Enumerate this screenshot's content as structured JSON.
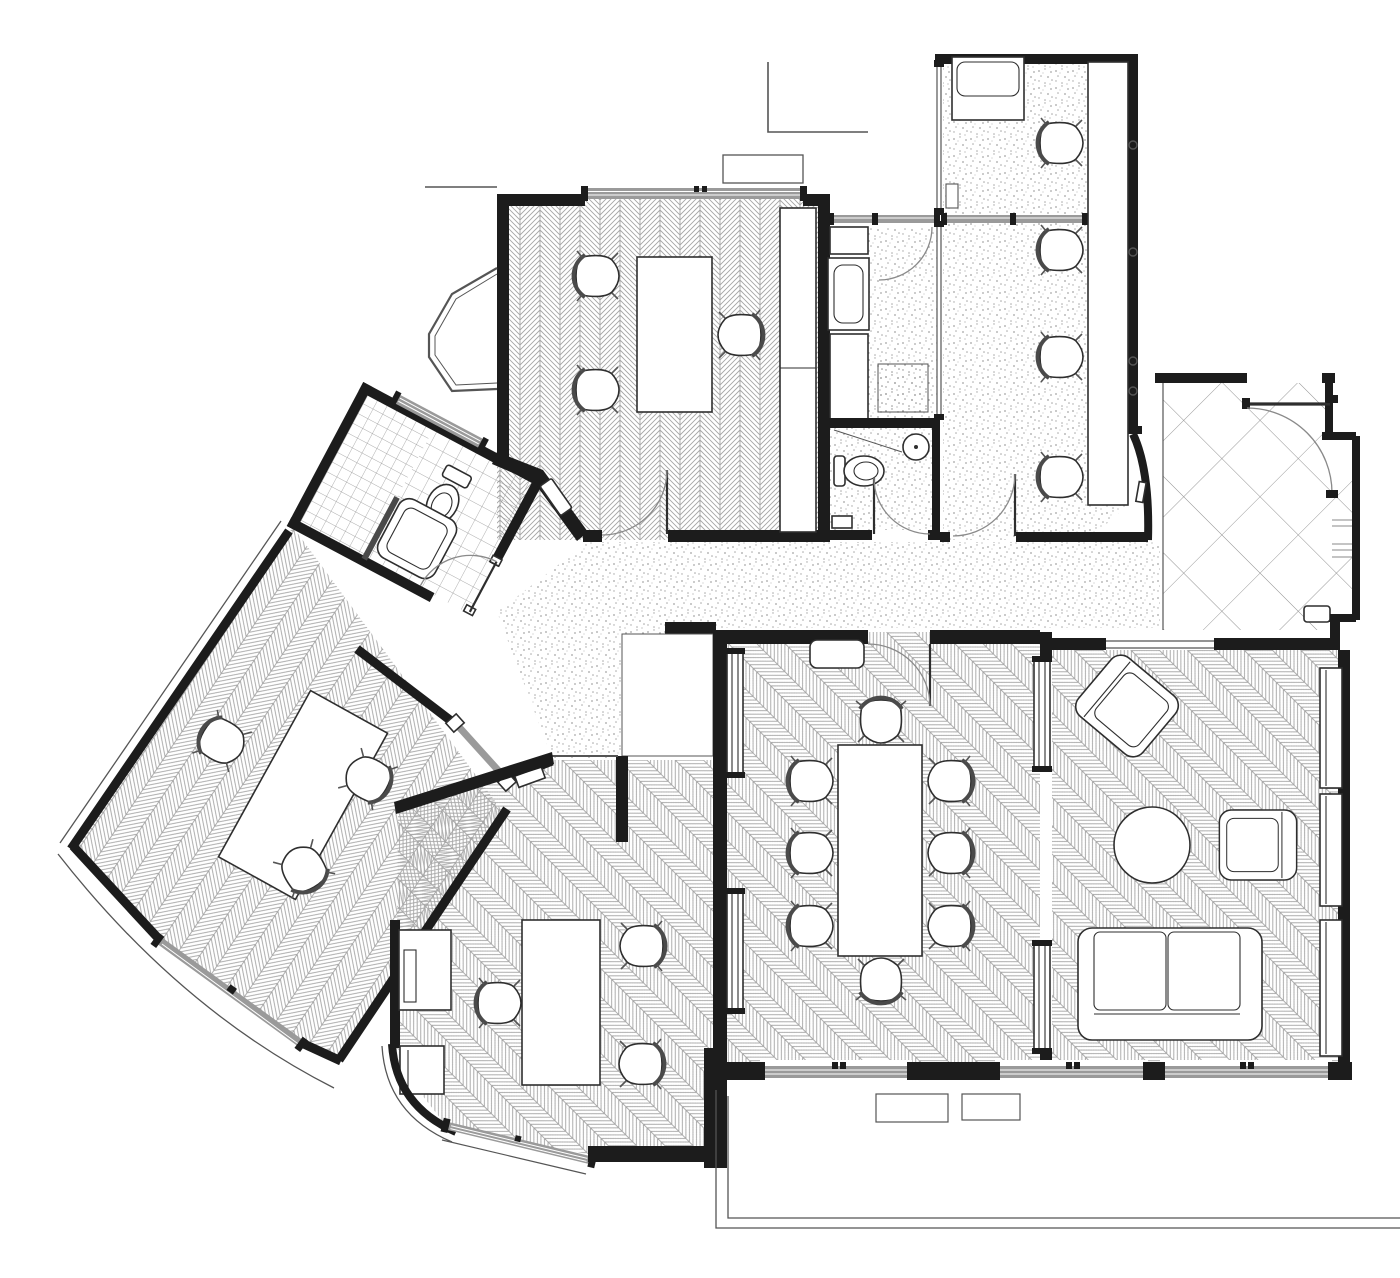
{
  "meta": {
    "kind": "architectural-floor-plan",
    "style": "monochrome CAD line drawing, top-down, no text labels visible"
  },
  "palette": {
    "bg": "#ffffff",
    "wall": "#1c1c1c",
    "furn": "#2e2e2e",
    "line": "#555555",
    "door": "#8a8a8a",
    "glazing": "#9a9a9a",
    "hatch": "#a6a6a6",
    "tile": "#8f8f8f",
    "stipple": "#a3a3a3"
  },
  "plan": {
    "rooms": [
      {
        "id": "office-nw",
        "floor": "herringbone-vertical",
        "furniture": [
          "desk",
          "task-chair",
          "task-chair",
          "task-chair",
          "tall-cabinet",
          "hinged-door",
          "window-band",
          "bay-window"
        ]
      },
      {
        "id": "kitchenette",
        "floor": "stipple",
        "furniture": [
          "counter",
          "sink",
          "appliance-square",
          "glazed-partition",
          "hinged-door"
        ]
      },
      {
        "id": "wc-center",
        "floor": "stipple",
        "furniture": [
          "toilet",
          "round-washbasin",
          "hinged-door"
        ]
      },
      {
        "id": "workroom-ne",
        "floor": "stipple",
        "furniture": [
          "daybed",
          "task-chair",
          "task-chair",
          "task-chair",
          "task-chair",
          "wall-counter",
          "glazed-partition",
          "hinged-door"
        ]
      },
      {
        "id": "hall",
        "floor": "stipple",
        "furniture": [
          "entry-shelf",
          "sliding-glass-door"
        ]
      },
      {
        "id": "bathroom-west",
        "floor": "square-tiles-rotated",
        "furniture": [
          "toilet",
          "shower-tray",
          "half-wall",
          "window-band",
          "hinged-door"
        ]
      },
      {
        "id": "office-west-rotated",
        "floor": "herringbone-rotated",
        "furniture": [
          "large-table",
          "task-chair",
          "task-chair",
          "task-chair",
          "curved-window-band"
        ]
      },
      {
        "id": "office-south",
        "floor": "herringbone-diagonal",
        "furniture": [
          "desk",
          "task-chair",
          "task-chair",
          "task-chair",
          "cabinet",
          "cabinet",
          "angled-window-band"
        ]
      },
      {
        "id": "meeting-room",
        "floor": "herringbone-diagonal",
        "furniture": [
          "conference-table",
          "task-chair",
          "task-chair",
          "task-chair",
          "task-chair",
          "task-chair",
          "task-chair",
          "task-chair",
          "task-chair",
          "radiator",
          "radiator",
          "radiator",
          "radiator",
          "sideboard",
          "hinged-door"
        ]
      },
      {
        "id": "lounge-se",
        "floor": "herringbone-diagonal",
        "furniture": [
          "two-seat-sofa",
          "armchair",
          "armchair",
          "round-coffee-table",
          "shelving-unit",
          "shelving-unit",
          "shelving-unit",
          "window-band",
          "window-band"
        ]
      },
      {
        "id": "vestibule-e",
        "floor": "large-diagonal-tiles",
        "furniture": [
          "hinged-door",
          "shelf-niche",
          "wall-console"
        ]
      }
    ],
    "exterior": [
      "property-lines-top",
      "planter-top",
      "terrace-outline-bottom",
      "planter-bottom",
      "planter-bottom",
      "facade-dots-east"
    ]
  }
}
